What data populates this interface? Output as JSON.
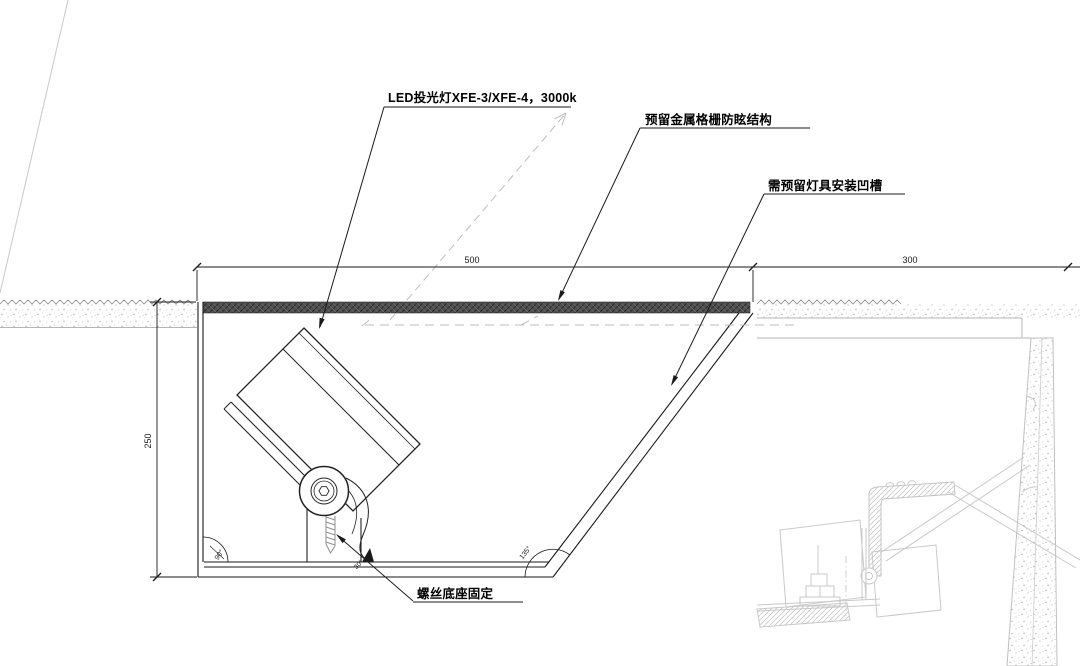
{
  "drawing": {
    "annotations": {
      "lamp": "LED投光灯XFE-3/XFE-4，3000k",
      "grille": "预留金属格栅防眩结构",
      "recess_groove": "需预留灯具安装凹槽",
      "screw_base": "螺丝底座固定"
    },
    "dimensions": {
      "recess_width": "500",
      "right_width": "300",
      "recess_height": "250"
    },
    "angles": {
      "corner_left": "90°",
      "screw_leader": "30°",
      "corner_right": "135°"
    },
    "colors": {
      "line": "#1a1a1a",
      "grille_band": "#4f4f4f",
      "ghost_gray": "#bdbdbd",
      "underlay_gray": "#c9c9c9",
      "background": "#ffffff"
    }
  }
}
